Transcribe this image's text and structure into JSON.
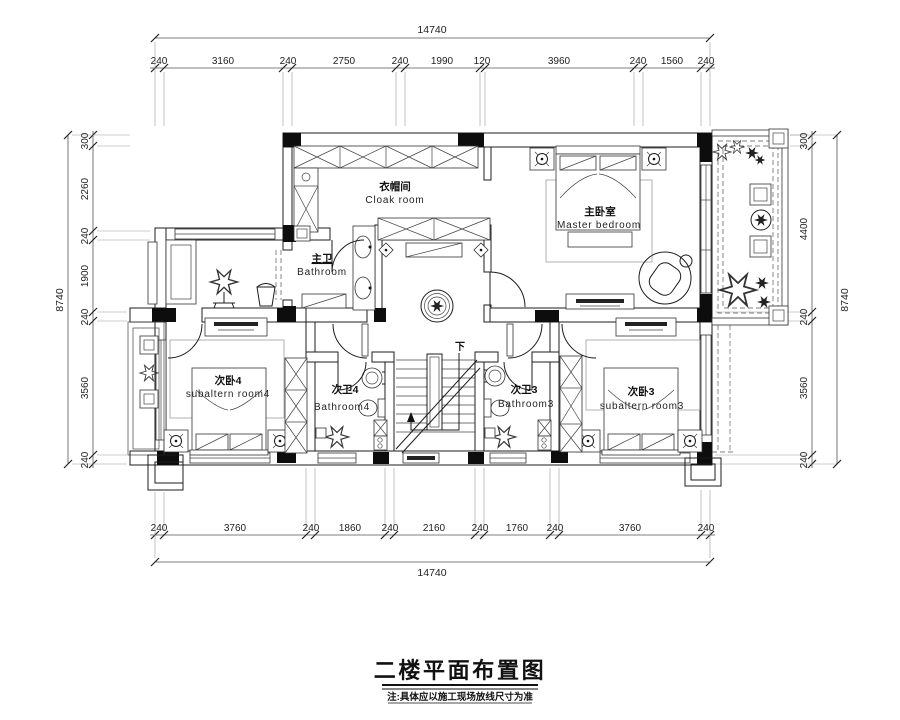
{
  "title": {
    "text": "二楼平面布置图",
    "note": "注:具体应以施工现场放线尺寸为准"
  },
  "rooms": {
    "cloak": {
      "zh": "衣帽间",
      "en": "Cloak  room"
    },
    "master": {
      "zh": "主卧室",
      "en": "Master  bedroom"
    },
    "master_bath": {
      "zh": "主卫",
      "en": "Bathroom"
    },
    "bedroom4": {
      "zh": "次卧4",
      "en": "subaltern  room4"
    },
    "bath4": {
      "zh": "次卫4",
      "en": "Bathroom4"
    },
    "bath3": {
      "zh": "次卫3",
      "en": "Bathroom3"
    },
    "bedroom3": {
      "zh": "次卧3",
      "en": "subaltern  room3"
    }
  },
  "stairs": {
    "down_label": "下"
  },
  "dimensions": {
    "top": {
      "total": "14740",
      "segments": [
        "240",
        "3160",
        "240",
        "2750",
        "240",
        "1990",
        "120",
        "3960",
        "240",
        "1560",
        "240"
      ]
    },
    "bottom": {
      "total": "14740",
      "segments": [
        "240",
        "3760",
        "240",
        "1860",
        "240",
        "2160",
        "240",
        "1760",
        "240",
        "3760",
        "240"
      ]
    },
    "left": {
      "total": "8740",
      "segments": [
        "300",
        "2260",
        "240",
        "1900",
        "240",
        "3560",
        "240"
      ]
    },
    "right": {
      "total": "8740",
      "segments": [
        "300",
        "4400",
        "240",
        "3560",
        "240"
      ]
    }
  },
  "colors": {
    "line": "#1c1c1c",
    "dim_text": "#222222",
    "background": "#ffffff"
  }
}
